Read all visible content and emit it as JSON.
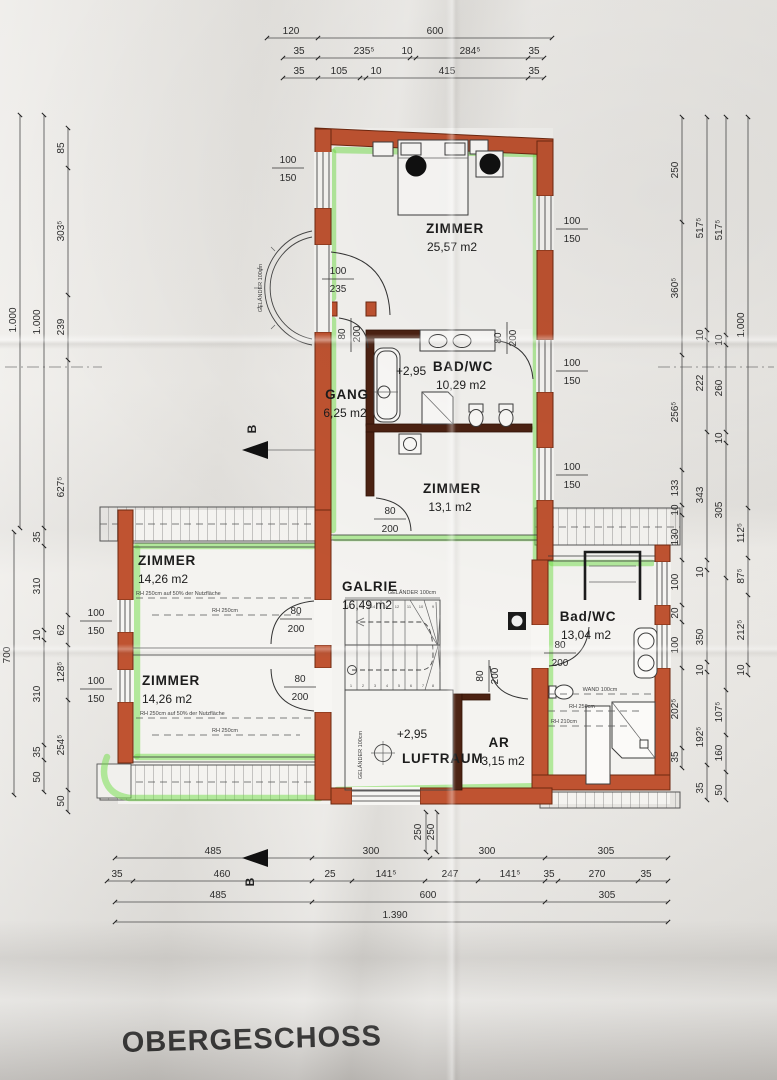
{
  "title": "OBERGESCHOSS",
  "labels": {
    "gelaender": "GELÄNDER 100cm",
    "section": "B"
  },
  "rooms": {
    "zimmer_top": {
      "name": "ZIMMER",
      "area": "25,57 m2"
    },
    "bad_top": {
      "name": "BAD/WC",
      "area": "10,29 m2",
      "level": "+2,95"
    },
    "gang": {
      "name": "GANG",
      "area": "6,25 m2"
    },
    "zimmer_mid": {
      "name": "ZIMMER",
      "area": "13,1  m2"
    },
    "zimmer_left1": {
      "name": "ZIMMER",
      "area": "14,26 m2",
      "note1": "RH 250cm auf 50% der Nutzfläche",
      "note2": "RH 250cm"
    },
    "galerie": {
      "name": "GALRIE",
      "area": "16,49 m2"
    },
    "bad_right": {
      "name": "Bad/WC",
      "area": "13,04 m2",
      "note1": "WAND 100cm",
      "note2": "RH 250cm",
      "note3": "RH 210cm"
    },
    "zimmer_left2": {
      "name": "ZIMMER",
      "area": "14,26 m2",
      "note1": "RH 250cm auf 50% der Nutzfläche",
      "note2": "RH 250cm"
    },
    "luftraum": {
      "name": "LUFTRAUM",
      "level": "+2,95"
    },
    "ar": {
      "name": "AR",
      "area": "3,15 m2"
    }
  },
  "openings": {
    "win_w": "100",
    "win_h": "150",
    "door_w": "80",
    "door_h": "200",
    "bal_w": "100",
    "bal_h": "235"
  },
  "dims": {
    "top1": [
      "120",
      "600"
    ],
    "top2": [
      "35",
      "235⁵",
      "10",
      "284⁵",
      "35"
    ],
    "top3": [
      "35",
      "105",
      "10",
      "415",
      "35"
    ],
    "bottom1": [
      "485",
      "300",
      "300",
      "305"
    ],
    "bottom2": [
      "35",
      "460",
      "25",
      "141⁵",
      "247",
      "141⁵",
      "35",
      "270",
      "35"
    ],
    "bottom3": [
      "485",
      "600",
      "305"
    ],
    "bottom4": [
      "1.390"
    ],
    "stair": [
      "250",
      "250"
    ],
    "left_outer": [
      "1.000",
      "700"
    ],
    "left_mid": [
      "1.000",
      "35",
      "310",
      "10",
      "310",
      "35",
      "50"
    ],
    "left_inner": [
      "85",
      "303⁵",
      "239",
      "627⁵",
      "62",
      "128⁵",
      "254⁵",
      "50"
    ],
    "right1": [
      "250",
      "360⁵",
      "256⁵",
      "133",
      "10",
      "130",
      "100",
      "20",
      "100",
      "202⁵",
      "35"
    ],
    "right2": [
      "517⁵",
      "10",
      "222",
      "343",
      "10",
      "350",
      "10",
      "192⁵",
      "35"
    ],
    "right3": [
      "517⁵",
      "10",
      "260",
      "10",
      "305",
      "107⁵",
      "160",
      "50"
    ],
    "right4": [
      "1.000",
      "112⁵",
      "87⁵",
      "212⁵",
      "10"
    ]
  },
  "stairs": {
    "low": [
      "1",
      "2",
      "3",
      "4",
      "5",
      "6",
      "7",
      "8"
    ],
    "up": [
      "9",
      "10",
      "11",
      "12",
      "13",
      "14",
      "15",
      "16"
    ]
  }
}
